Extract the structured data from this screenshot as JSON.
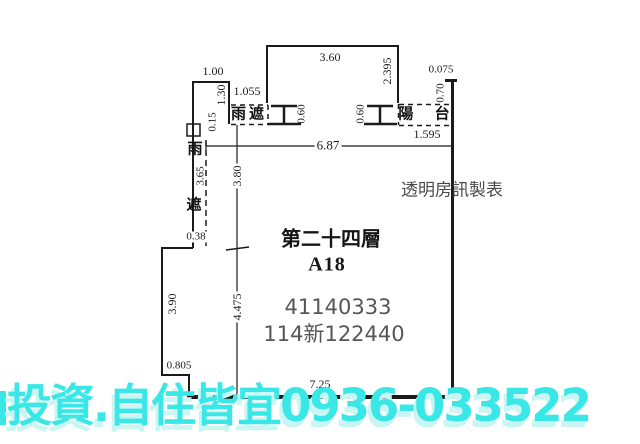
{
  "colors": {
    "plan_line": "#1b1b1b",
    "dim_text": "#1b1b1b",
    "gray_text": "#565656",
    "credit_text": "#4a4a4a",
    "watermark_text": "#3ae7e7",
    "watermark_shadow": "#c9f6f3",
    "background": "#ffffff"
  },
  "plan": {
    "dims": {
      "top_small_width": "1.00",
      "top_big_width": "3.60",
      "top_right_height": "2.395",
      "top_right_small": "0.075",
      "canopy_width": "1.055",
      "canopy_height": "1.30",
      "wall_offset": "0.15",
      "window_left": "0.60",
      "window_right": "0.60",
      "parapet_height": "0.70",
      "total_width": "6.87",
      "balcony_width": "1.595",
      "interior_upper": "3.80",
      "left_canopy_len": "3.65",
      "left_jog": "0.38",
      "left_lower_height": "3.90",
      "interior_lower": "4.475",
      "bottom_left_jog": "0.805",
      "bottom_width": "7.25"
    },
    "areas": {
      "rain_canopy_top": "雨遮",
      "rain_canopy_left_char1": "雨",
      "rain_canopy_left_char2": "遮",
      "balcony": "陽 台"
    },
    "unit": {
      "floor": "第二十四層",
      "unit_id": "A18",
      "reg_no_1": "41140333",
      "reg_no_2": "114新122440"
    },
    "credit": "透明房訊製表"
  },
  "watermark": {
    "text": "投資.自住皆宜0936-033522"
  }
}
